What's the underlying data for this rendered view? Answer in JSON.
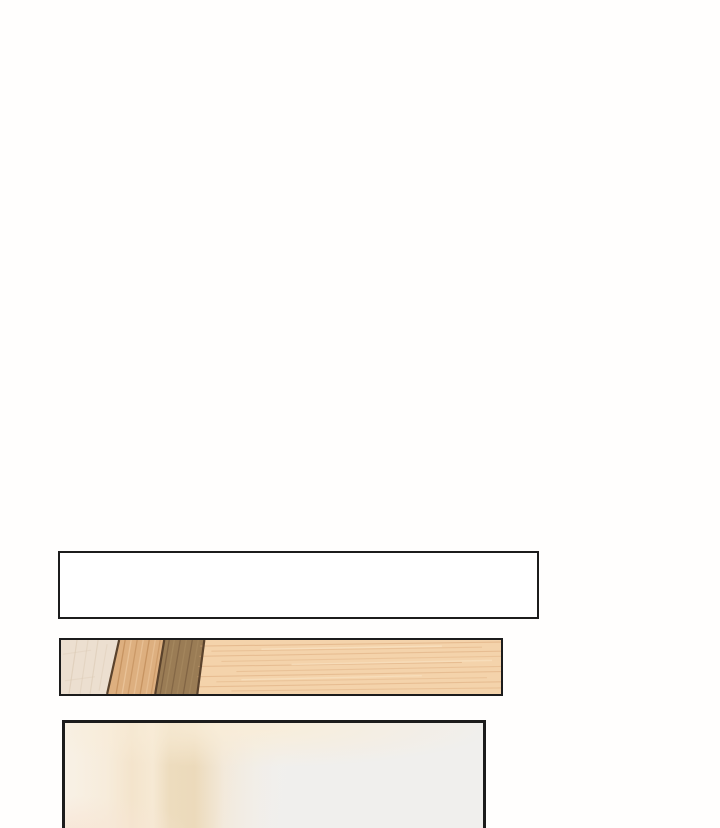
{
  "page": {
    "width": 720,
    "height": 828,
    "kind": "webtoon-strip-segment",
    "background_color": "#fffefd",
    "ink_color": "#1c1c1c"
  },
  "panels": {
    "caption_box": {
      "alt": "empty white narration box",
      "fill": "#ffffff",
      "border_color": "#1c1c1c",
      "text": ""
    },
    "wood_bar": {
      "alt": "wood table edge with four diagonal plank sections",
      "border_color": "#1c1c1c",
      "divider_color": "#5a422c",
      "sections": [
        {
          "name": "pale-plank",
          "base": "#ecdfd0",
          "grain": "#d9c7b0"
        },
        {
          "name": "tan-plank",
          "base": "#ddaf7f",
          "grain": "#c08b58",
          "highlight": "#ecc79e"
        },
        {
          "name": "dark-plank",
          "base": "#9a7c55",
          "grain": "#7c5f41",
          "highlight": "#a98c62"
        },
        {
          "name": "light-plank",
          "base": "#f4d3ab",
          "grain": "#dca97a",
          "highlight": "#fae4c4"
        }
      ]
    },
    "room_panel": {
      "alt": "blurred cream room interior, cropped at page bottom",
      "border_color": "#1c1c1c",
      "glow_warm": "rgba(249,237,216,0.95)",
      "glow_corner": "rgba(247,229,213,0.85)",
      "band_beige": "#ecdabb",
      "wall_gray": "#f0efed"
    }
  }
}
